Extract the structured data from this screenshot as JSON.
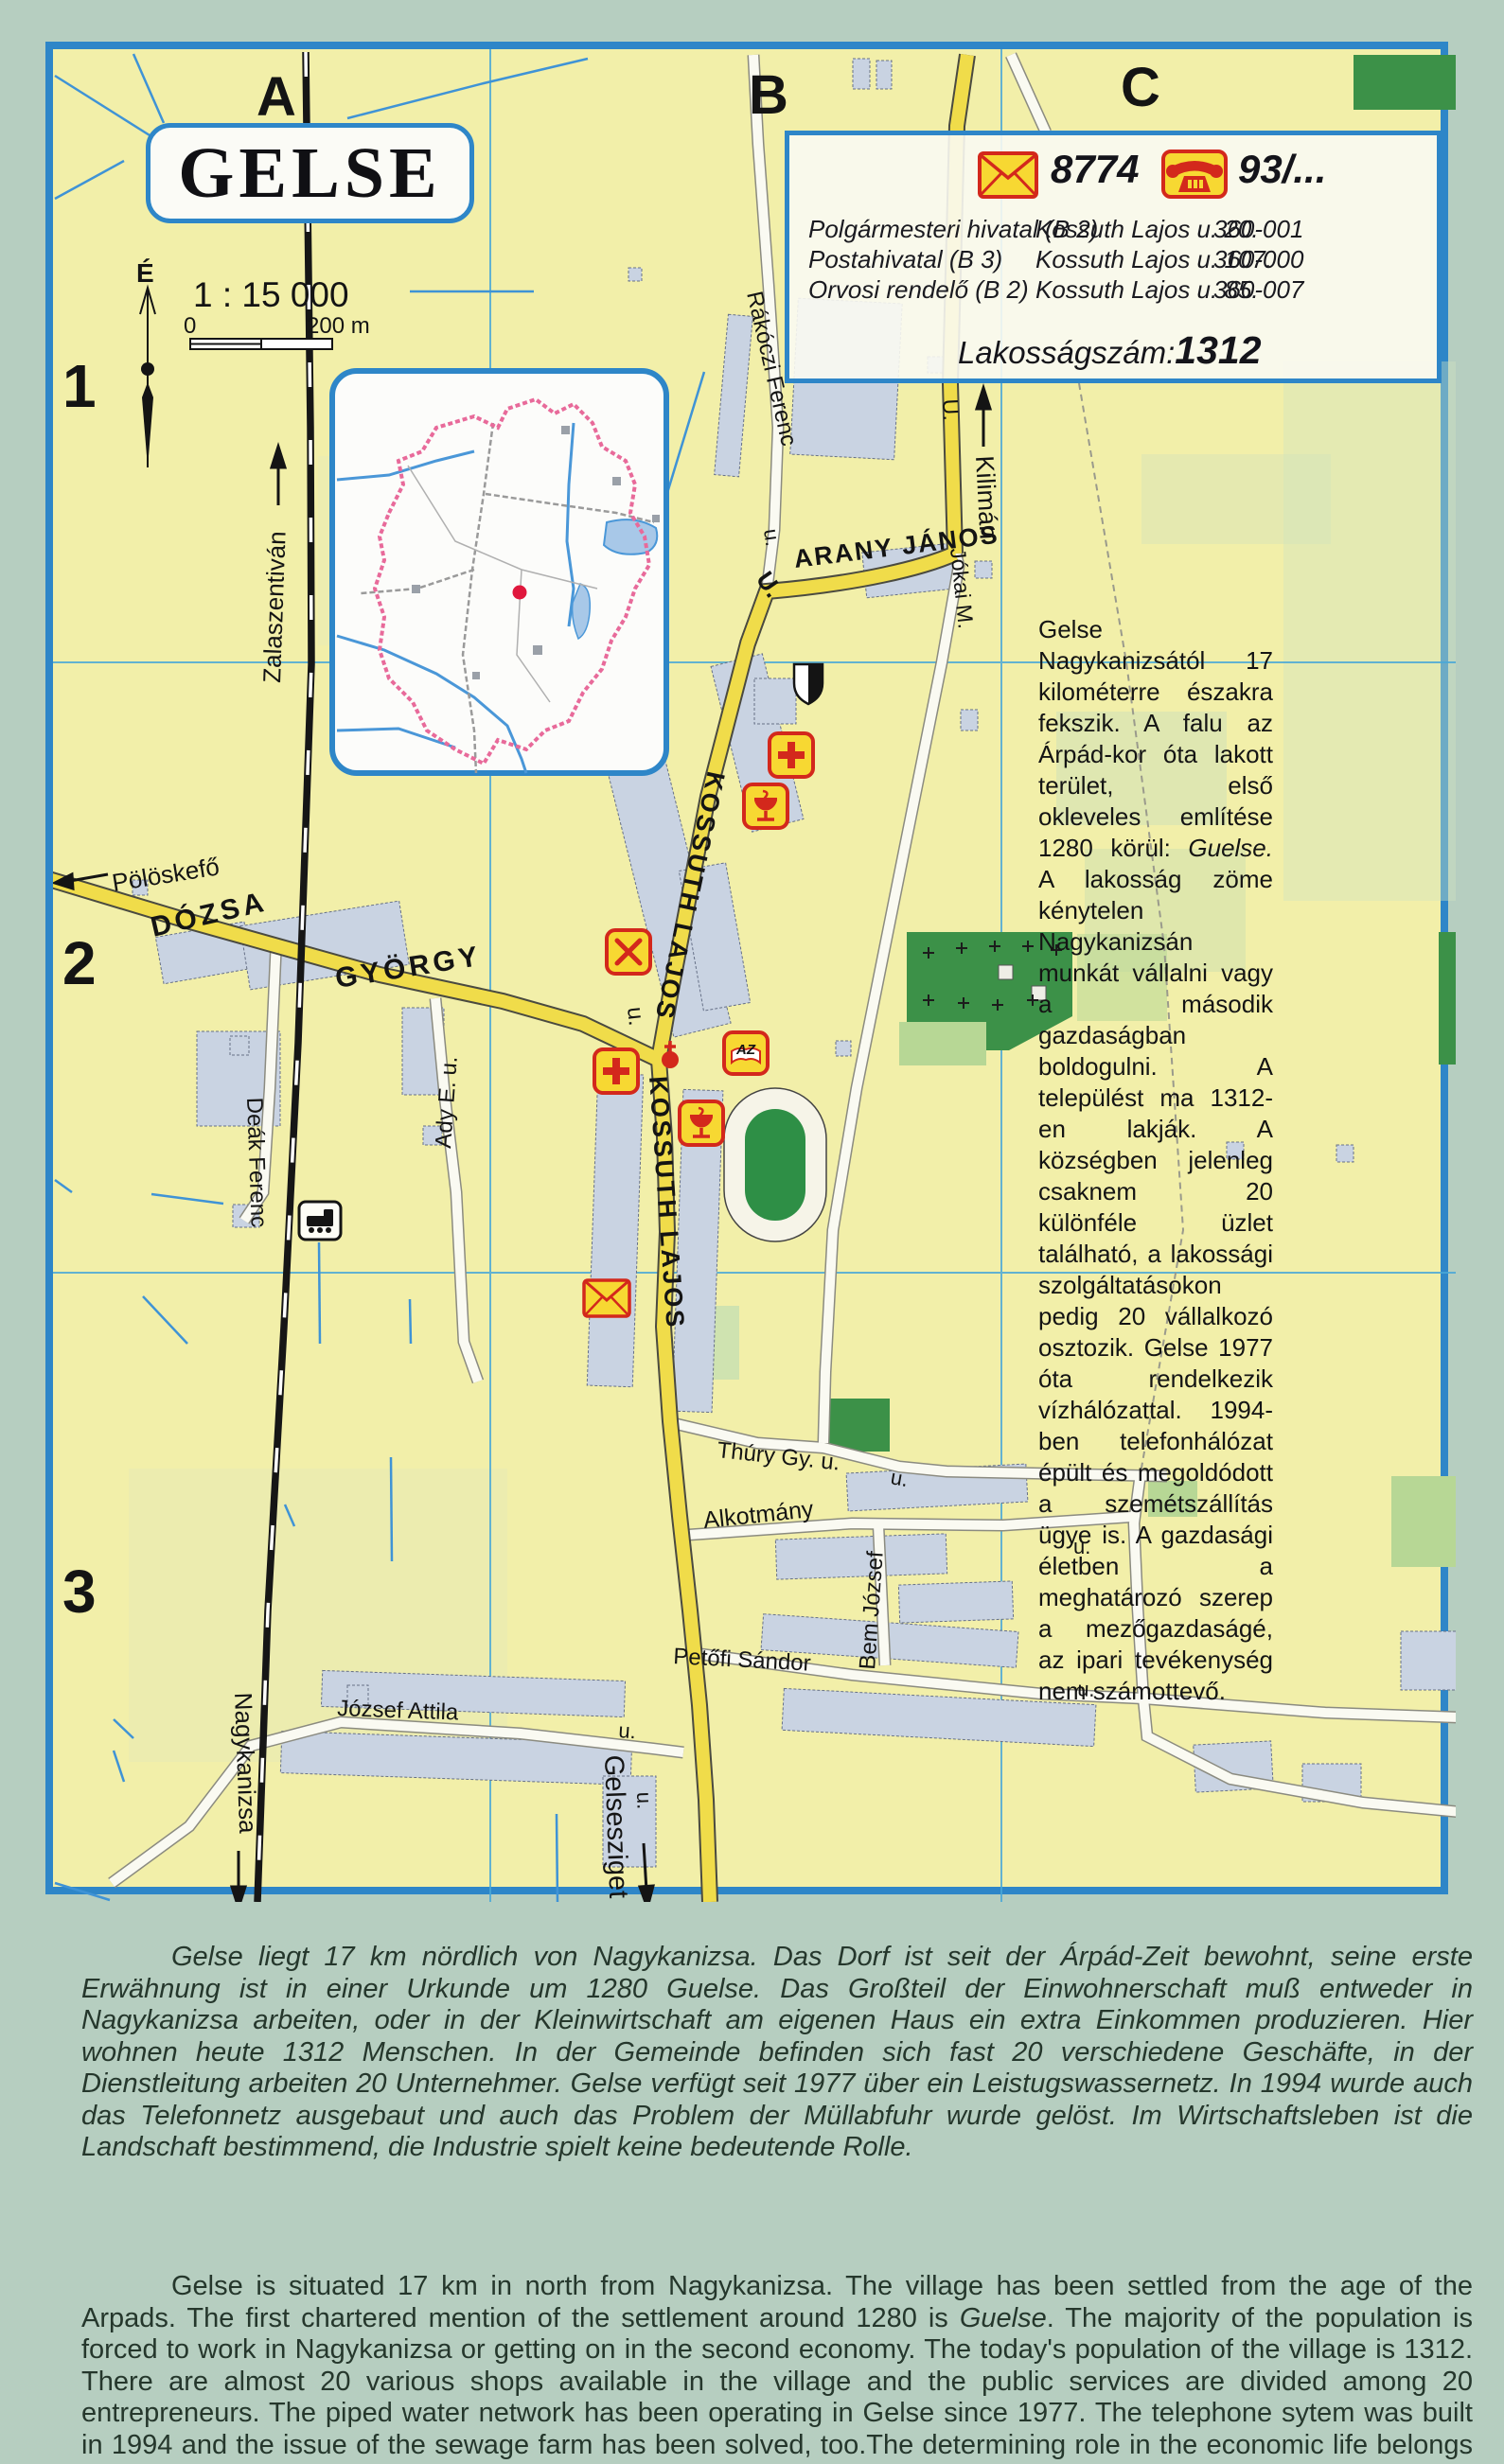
{
  "title": "GELSE",
  "compass": {
    "north": "É"
  },
  "scale": {
    "ratio": "1 : 15 000",
    "zero": "0",
    "max": "200 m"
  },
  "grid": {
    "cols": [
      "A",
      "B",
      "C"
    ],
    "rows": [
      "1",
      "2",
      "3"
    ]
  },
  "infobox": {
    "postal_code": "8774",
    "phone_prefix": "93/...",
    "rows": [
      {
        "name": "Polgármesteri hivatal (B 2)",
        "address": "Kossuth Lajos u. 20.",
        "phone": "360-001"
      },
      {
        "name": "Postahivatal (B 3)",
        "address": "Kossuth Lajos u. 107.",
        "phone": "360-000"
      },
      {
        "name": "Orvosi rendelő (B 2)",
        "address": "Kossuth Lajos u. 85.",
        "phone": "360-007"
      }
    ],
    "population_label": "Lakosságszám:",
    "population_value": "1312"
  },
  "streets": {
    "kossuth_north": "KOSSUTH LAJOS",
    "kossuth_south": "KOSSUTH LAJOS",
    "arany_janos": "ARANY JÁNOS",
    "arany_u": "U.",
    "dozsa": "DÓZSA",
    "gyorgy": "GYÖRGY",
    "dozsa_u": "u.",
    "rakoczi": "Rákóczi Ferenc",
    "rakoczi_u": "u.",
    "kiliman": "Kilimán",
    "kiliman_u": "U.",
    "jokai": "Jókai M.",
    "thury": "Thúry Gy. u.",
    "thury_u": "u.",
    "alkotmany": "Alkotmány",
    "alkotmany_u": "u.",
    "bem": "Bem József",
    "petofi": "Petőfi Sándor",
    "petofi_u": "u.",
    "jozsef_attila": "József Attila",
    "jozsef_attila_u": "u.",
    "gelsesziget": "Gelsesziget",
    "gelsesziget_u": "u.",
    "nagykanizsa": "Nagykanizsa",
    "zalaszentivan": "Zalaszentiván",
    "deak": "Deák Ferenc",
    "ady": "Ady E. u.",
    "poloskefo": "Pölöskefő"
  },
  "poi": {
    "az": "AZ"
  },
  "paragraphs": {
    "hu": {
      "part1": "Gelse Nagykanizsától 17 kilométerre északra fekszik. A falu az Árpád-kor óta lakott terület, első okleveles említése 1280 körül: ",
      "emph": "Guelse.",
      "part2": " A lakosság zöme kénytelen Nagykanizsán munkát vállalni vagy a második gazdaságban boldogulni. A települést ma 1312-en lakják. A községben jelenleg csaknem 20 különféle üzlet található, a lakossági szolgáltatásokon pedig 20 vállalkozó osztozik. Gelse 1977 óta rendelkezik vízhálózattal. 1994-ben telefonhálózat épült és megoldódott a szemétszállítás ügye is. A gazdasági életben a meghatározó szerep a mezőgazdaságé, az ipari tevékenység nem számottevő."
    },
    "de": "Gelse liegt 17 km nördlich von Nagykanizsa. Das Dorf ist seit der Árpád-Zeit bewohnt, seine erste Erwähnung ist in einer Urkunde um 1280 Guelse. Das Großteil der Einwohnerschaft muß entweder in Nagykanizsa arbeiten, oder in der Kleinwirtschaft am eigenen Haus ein extra Einkommen produzieren. Hier wohnen heute 1312 Menschen. In der Gemeinde befinden sich fast 20 verschiedene Geschäfte, in der Dienstleitung arbeiten 20 Unternehmer. Gelse verfügt seit 1977 über ein Leistugswassernetz. In 1994 wurde auch das Telefonnetz ausgebaut und auch das Problem der Müllabfuhr wurde gelöst. Im Wirtschaftsleben ist die Landschaft bestimmend, die Industrie spielt keine bedeutende Rolle.",
    "en": {
      "part1": "Gelse is situated 17 km in north from Nagykanizsa. The village has been settled from the age of the Arpads. The first chartered mention of the settlement around 1280 is ",
      "emph": "Guelse",
      "part2": ". The majority of the population is forced to work in Nagykanizsa or getting on in the second economy. The today's population of the village is 1312. There are almost 20 various shops available in the village and the public services are divided among 20 entrepreneurs. The piped water network has been operating in Gelse since 1977. The telephone sytem was built in 1994 and the issue of the sewage farm has been solved, too.The determining role in the economic life belongs to the agriculture, the industrial activity is not considerable."
    }
  },
  "colors": {
    "frame": "#2e86c8",
    "road_main": "#f0dc4a",
    "building": "#c9d3e2",
    "green_dark": "#3c9148",
    "green_light": "#b7d795",
    "poi_red": "#d3281c",
    "poi_yellow": "#f7d832",
    "label_blue": "#2f82b5",
    "water": "#3f93d6"
  }
}
